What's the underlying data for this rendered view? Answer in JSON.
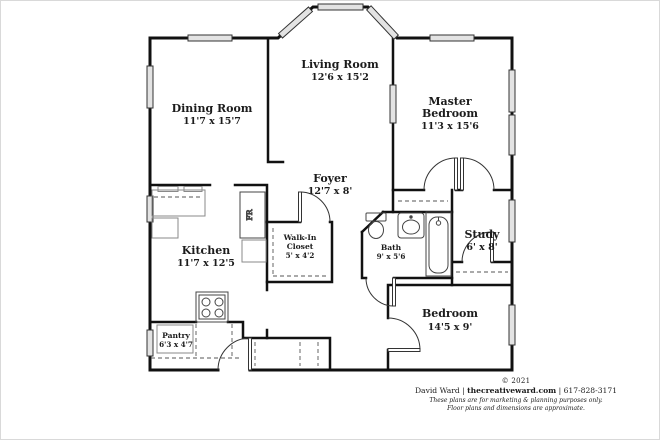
{
  "rooms": [
    {
      "name": "Living Room",
      "dims": "12'6 x 15'2"
    },
    {
      "name": "Dining Room",
      "dims": "11'7 x 15'7"
    },
    {
      "name": "Master",
      "name2": "Bedroom",
      "dims": "11'3 x 15'6"
    },
    {
      "name": "Foyer",
      "dims": "12'7 x 8'"
    },
    {
      "name": "Kitchen",
      "dims": "11'7 x 12'5"
    },
    {
      "name": "Walk-In",
      "name2": "Closet",
      "dims": "5' x 4'2"
    },
    {
      "name": "Bath",
      "dims": "9' x 5'6"
    },
    {
      "name": "Study",
      "dims": "6' x 8'"
    },
    {
      "name": "Bedroom",
      "dims": "14'5 x 9'"
    },
    {
      "name": "Pantry",
      "dims": "6'3 x 4'7"
    }
  ],
  "fixtures": {
    "refrigerator_label": "FR"
  },
  "footer": {
    "copyright": "© 2021",
    "owner": "David Ward",
    "sep": "|",
    "site": "thecreativeward.com",
    "phone": "617-828-3171",
    "disclaimer1": "These plans are for marketing & planning purposes only.",
    "disclaimer2": "Floor plans and dimensions are approximate."
  },
  "colors": {
    "wall": "#111111",
    "window_fill": "#e3e3e3",
    "fixture_line": "#555555",
    "counter_line": "#8a8a8a",
    "background": "#ffffff"
  }
}
